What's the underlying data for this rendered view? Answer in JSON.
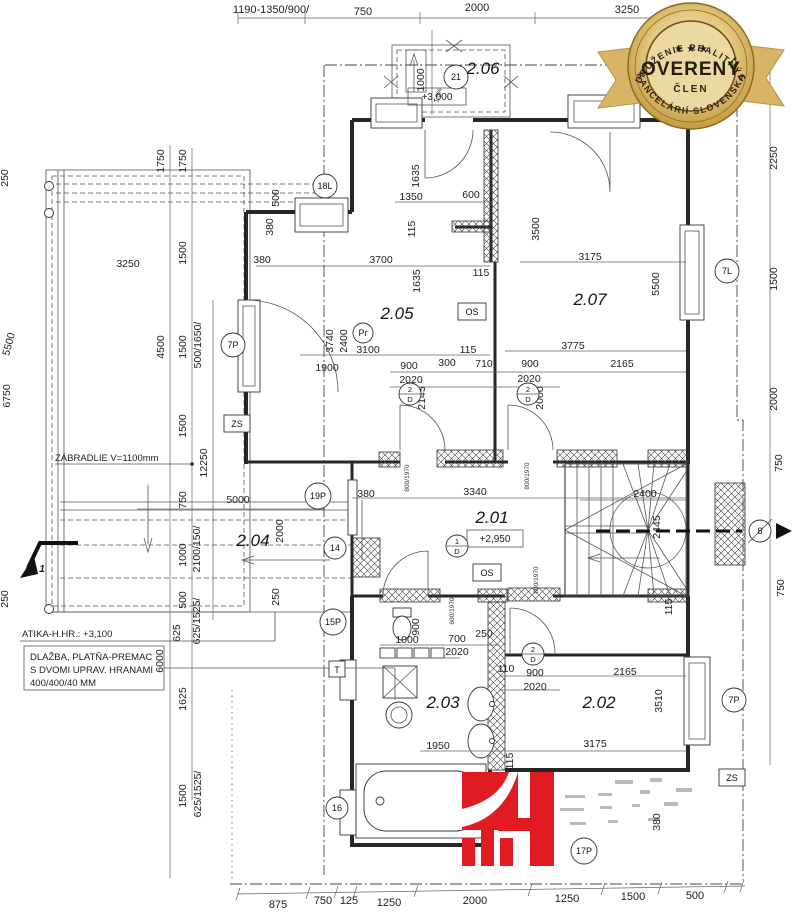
{
  "badge": {
    "arc_top": "ZDRUŽENIE REALITNÝCH",
    "stars": "★ ★ ★",
    "title": "OVERENÝ",
    "member": "ČLEN",
    "arc_bottom": "KANCELÁRIÍ SLOVENSKA"
  },
  "colors": {
    "accent_red": "#e11b22",
    "badge_gold": "#c9a13b",
    "badge_gold_light": "#ecd9a2",
    "line": "#262626"
  },
  "rooms": {
    "r201": "2.01",
    "r202": "2.02",
    "r203": "2.03",
    "r204": "2.04",
    "r205": "2.05",
    "r206": "2.06",
    "r207": "2.07"
  },
  "levels": {
    "entry": "+3,000",
    "floor": "+2,950"
  },
  "markers": {
    "c18l": "18L",
    "c21": "21",
    "c7l": "7L",
    "c7p": "7P",
    "c19p": "19P",
    "c14": "14",
    "c15p": "15P",
    "c16": "16",
    "c17p": "17P",
    "c8": "8",
    "pr": "Pr",
    "zs": "ZS",
    "os": "OS",
    "t": "T",
    "d1": "1",
    "d2": "2",
    "d": "D",
    "axis1": "1"
  },
  "notes": {
    "zabradlie": "ZÁBRADLIE V=1100mm",
    "atika": "ATIKA-H.HR.: +3,100",
    "dlazba1": "DLAŽBA, PLATŇA-PREMAC",
    "dlazba2": "S DVOMI UPRAV. HRANAMI",
    "dlazba3": "400/400/40 MM"
  },
  "dims": {
    "top": [
      "1190-1350/900/",
      "750",
      "2000",
      "3250"
    ],
    "porch": [
      "1000",
      "1,5%"
    ],
    "left": [
      "1750",
      "1750",
      "3250",
      "1500",
      "4500",
      "1500",
      "500/1650/",
      "6750",
      "5500",
      "250",
      "250",
      "12250",
      "1500",
      "750",
      "5000",
      "1000",
      "2100/150/",
      "2000",
      "500",
      "625/1525/",
      "250",
      "625",
      "6000",
      "1625",
      "1500",
      "625/1525/",
      "250"
    ],
    "r205": [
      "500",
      "380",
      "380",
      "3700",
      "1635",
      "1350",
      "115",
      "600",
      "1635",
      "115",
      "3740",
      "2400",
      "3100",
      "1900"
    ],
    "hall": [
      "900",
      "2020",
      "300",
      "710",
      "900",
      "2020",
      "2165",
      "3775",
      "115",
      "2145",
      "2000"
    ],
    "r207": [
      "3500",
      "3175",
      "5500"
    ],
    "right": [
      "2250",
      "1500",
      "2000",
      "750",
      "750"
    ],
    "r201": [
      "380",
      "3340",
      "800/1970",
      "600/1970",
      "2400",
      "2445",
      "115"
    ],
    "lower": [
      "1000",
      "900",
      "700",
      "2020",
      "250",
      "110",
      "900",
      "2020",
      "2165",
      "3175",
      "1950",
      "115",
      "3510",
      "380"
    ],
    "bottom": [
      "875",
      "750",
      "125",
      "1250",
      "2000",
      "1250",
      "1500",
      "500"
    ]
  }
}
